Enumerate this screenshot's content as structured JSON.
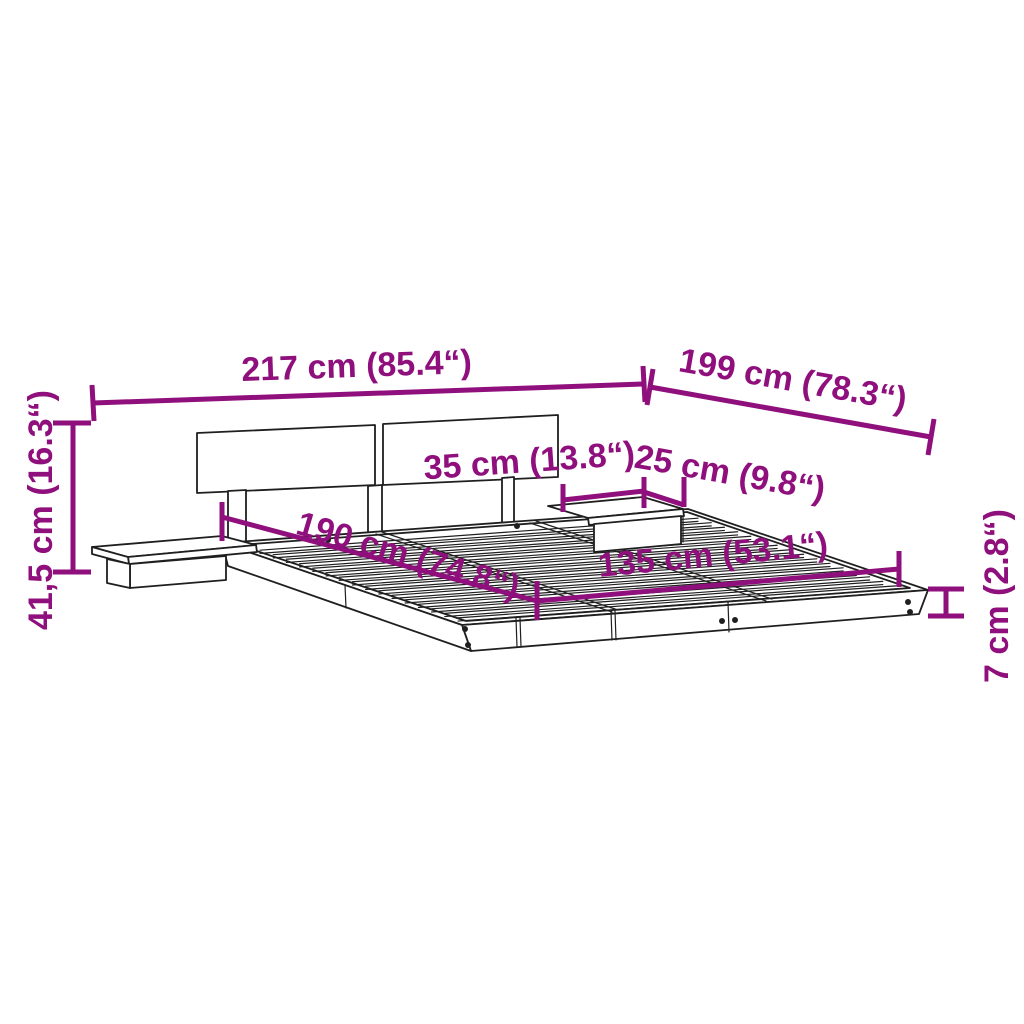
{
  "colors": {
    "dimension_accent": "#8F0F7C",
    "drawing_line": "#1F1F1F",
    "background": "#FFFFFF"
  },
  "illustration": {
    "name": "platform-bed-frame-with-headboard-and-floating-nightstands-line-drawing"
  },
  "dimensions": {
    "overall_width": {
      "label": "217 cm (85.4“)"
    },
    "overall_length": {
      "label": "199 cm (78.3“)"
    },
    "total_height": {
      "label": "41,5 cm (16.3“)"
    },
    "nightstand_depth": {
      "label": "35 cm (13.8“)"
    },
    "nightstand_width": {
      "label": "25 cm (9.8“)"
    },
    "inner_length": {
      "label": "190 cm (74.8“)"
    },
    "inner_width": {
      "label": "135 cm (53.1“)"
    },
    "platform_height": {
      "label": "7 cm (2.8“)"
    }
  }
}
